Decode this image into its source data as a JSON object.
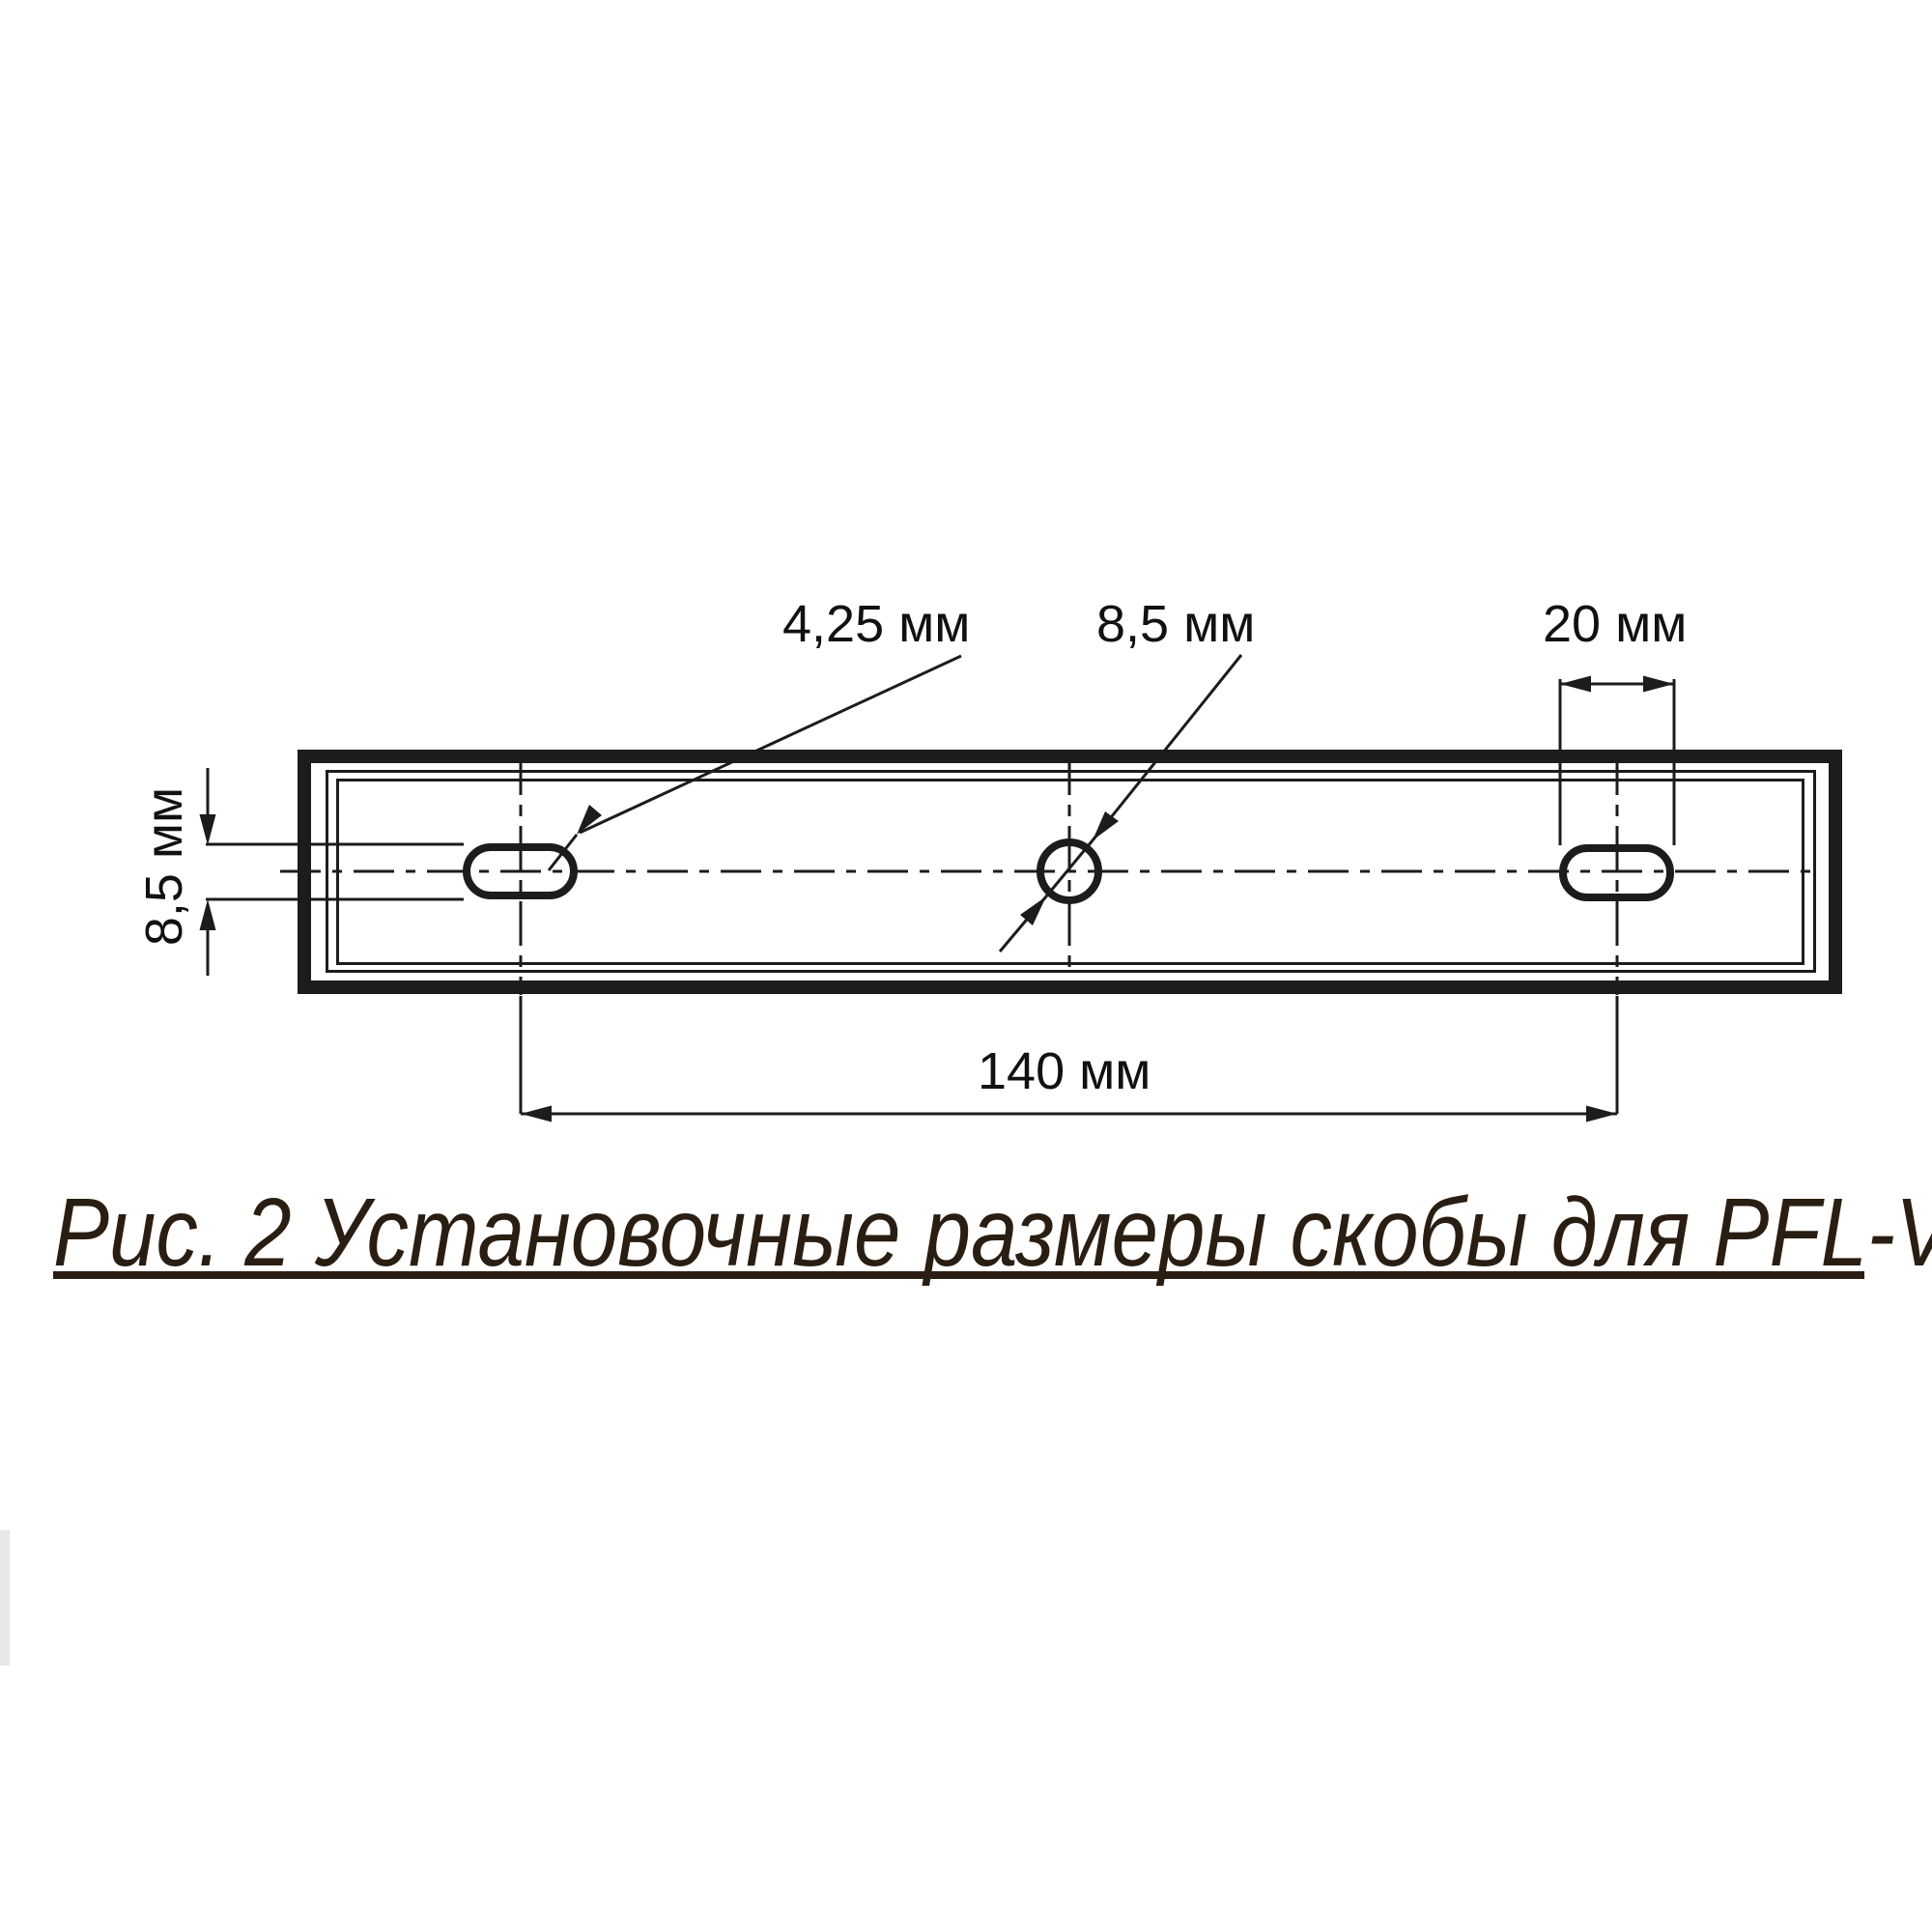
{
  "diagram": {
    "caption": "Рис. 2 Установочные размеры скобы для PFL-V",
    "dimensions": {
      "slot_hole_radius_label": "4,25 мм",
      "center_hole_diameter_label": "8,5 мм",
      "slot_length_label": "20 мм",
      "plate_slot_height_label": "8,5 мм",
      "hole_spacing_label": "140 мм"
    },
    "colors": {
      "line": "#1d1c1a",
      "label_text": "#111111",
      "caption_text": "#2a1e12",
      "artifact_gray": "#e8e8e8",
      "background": "#ffffff"
    }
  }
}
